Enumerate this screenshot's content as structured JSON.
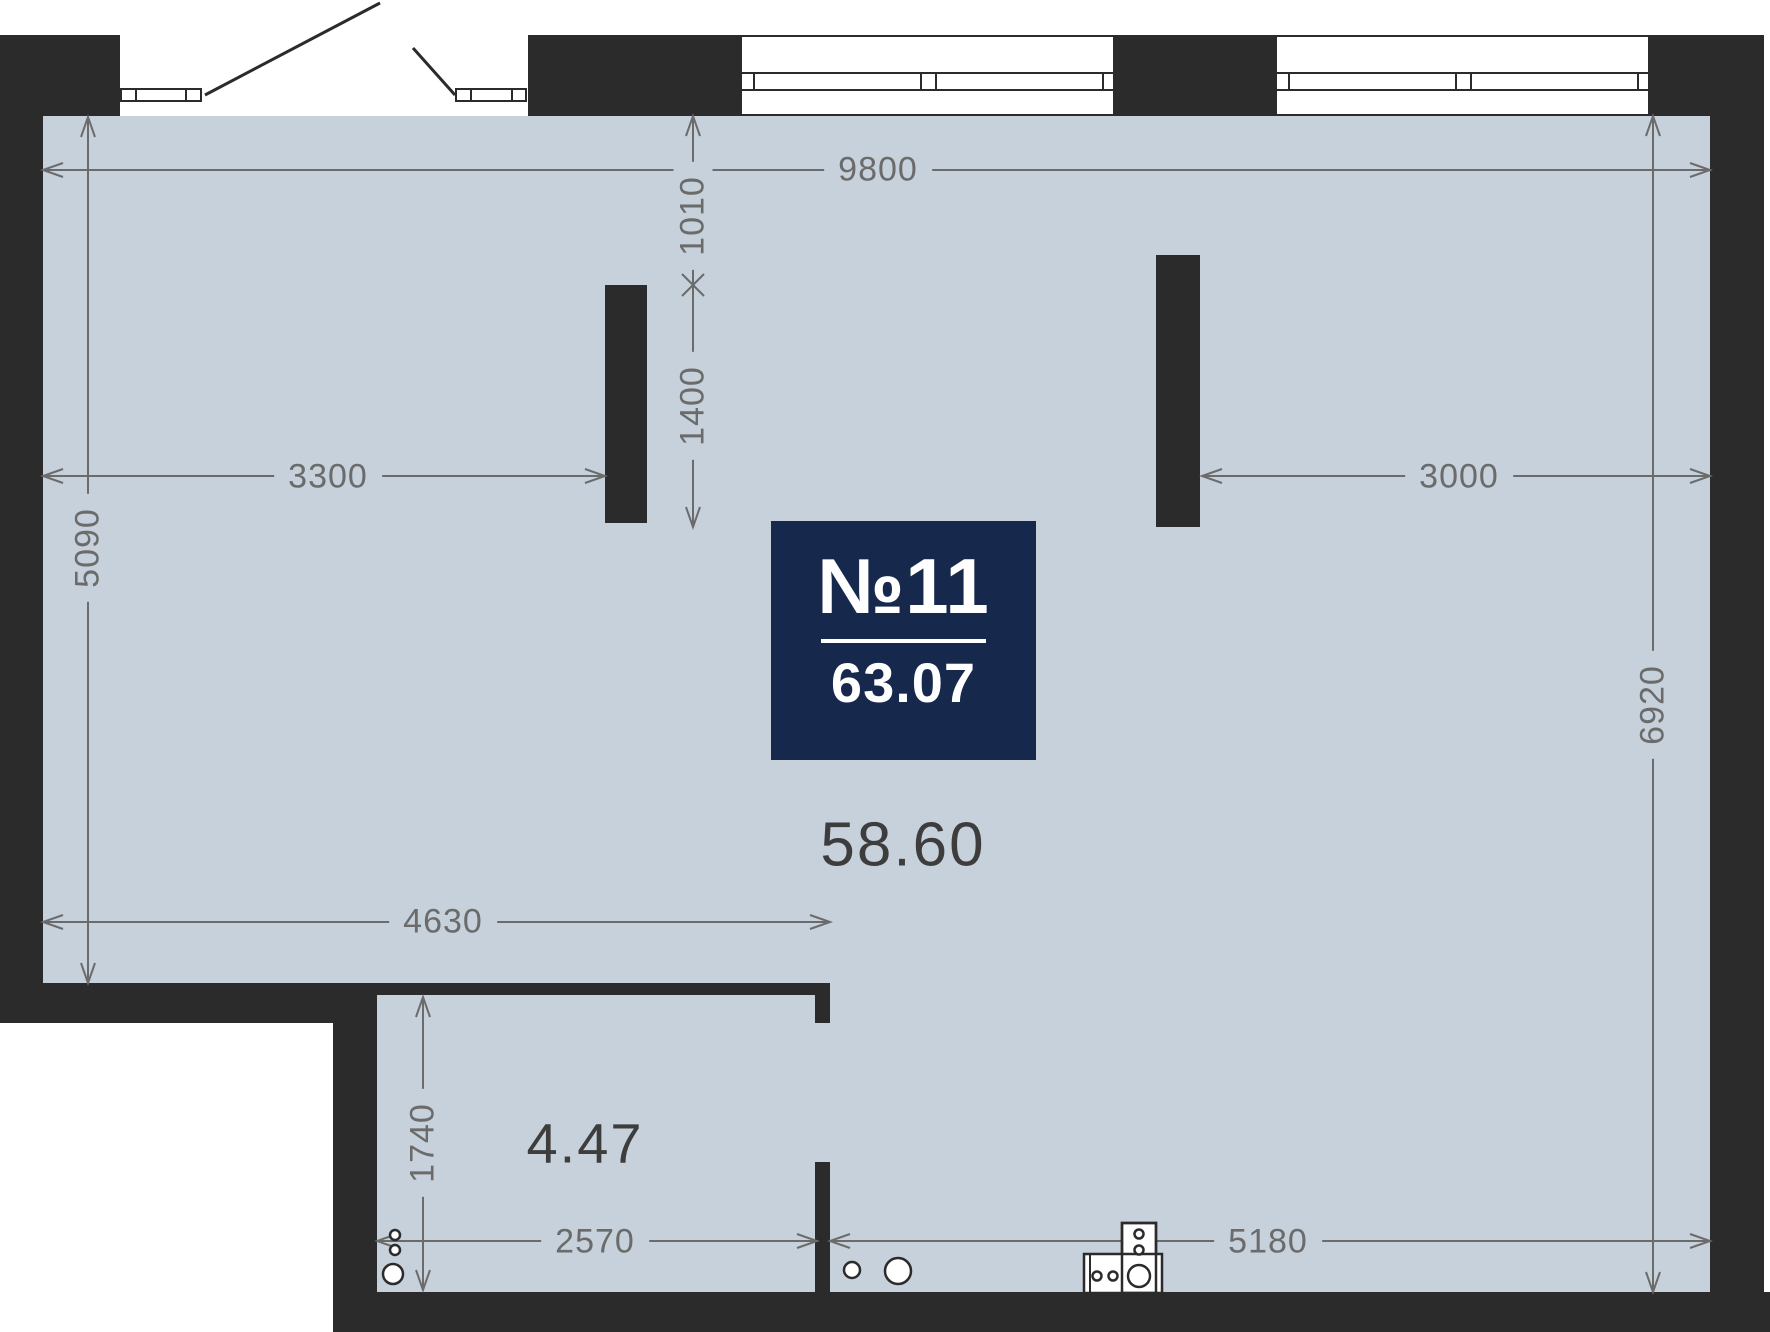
{
  "unit": {
    "number": "№11",
    "area": "63.07"
  },
  "rooms": {
    "main_area": "58.60",
    "small_area": "4.47"
  },
  "dims": {
    "top_width": "9800",
    "offset_top": "1010",
    "pillar_length": "1400",
    "left_width": "3300",
    "right_width": "3000",
    "left_height": "5090",
    "right_height": "6920",
    "mid_width": "4630",
    "small_room_height": "1740",
    "small_room_width": "2570",
    "bottom_width": "5180"
  },
  "colors": {
    "floor": "#c6d1db",
    "wall": "#2b2b2b",
    "dimension": "#6b6b6b",
    "area_text": "#3d3d3d",
    "badge_bg": "#16294d",
    "badge_text": "#ffffff"
  }
}
